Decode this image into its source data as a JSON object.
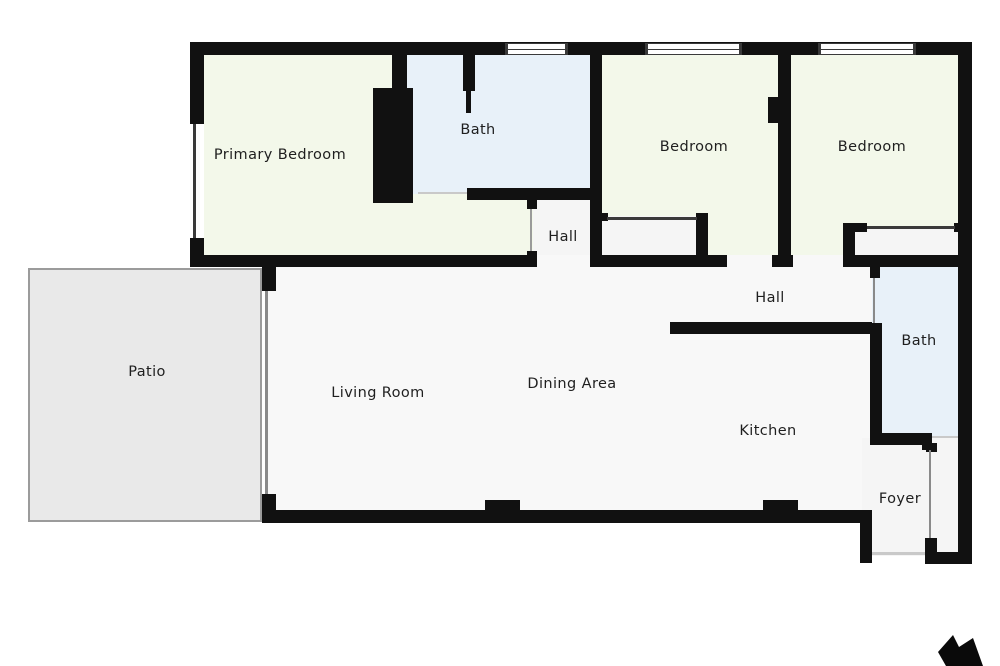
{
  "rooms": [
    {
      "id": "primary-bedroom",
      "label": "Primary Bedroom"
    },
    {
      "id": "bath-top",
      "label": "Bath"
    },
    {
      "id": "bedroom-1",
      "label": "Bedroom"
    },
    {
      "id": "bedroom-2",
      "label": "Bedroom"
    },
    {
      "id": "hall-upper",
      "label": "Hall"
    },
    {
      "id": "hall-lower",
      "label": "Hall"
    },
    {
      "id": "patio",
      "label": "Patio"
    },
    {
      "id": "living-room",
      "label": "Living Room"
    },
    {
      "id": "dining-area",
      "label": "Dining Area"
    },
    {
      "id": "kitchen",
      "label": "Kitchen"
    },
    {
      "id": "bath-right",
      "label": "Bath"
    },
    {
      "id": "foyer",
      "label": "Foyer"
    }
  ],
  "colors": {
    "wall": "#111111",
    "bedroom_floor": "#f3f8ea",
    "bath_floor": "#e8f1f9",
    "hall_floor": "#f5f5f5",
    "main_floor": "#f8f8f8",
    "patio_floor": "#e9e9e9"
  },
  "compass": {
    "icon": "north-arrow"
  }
}
